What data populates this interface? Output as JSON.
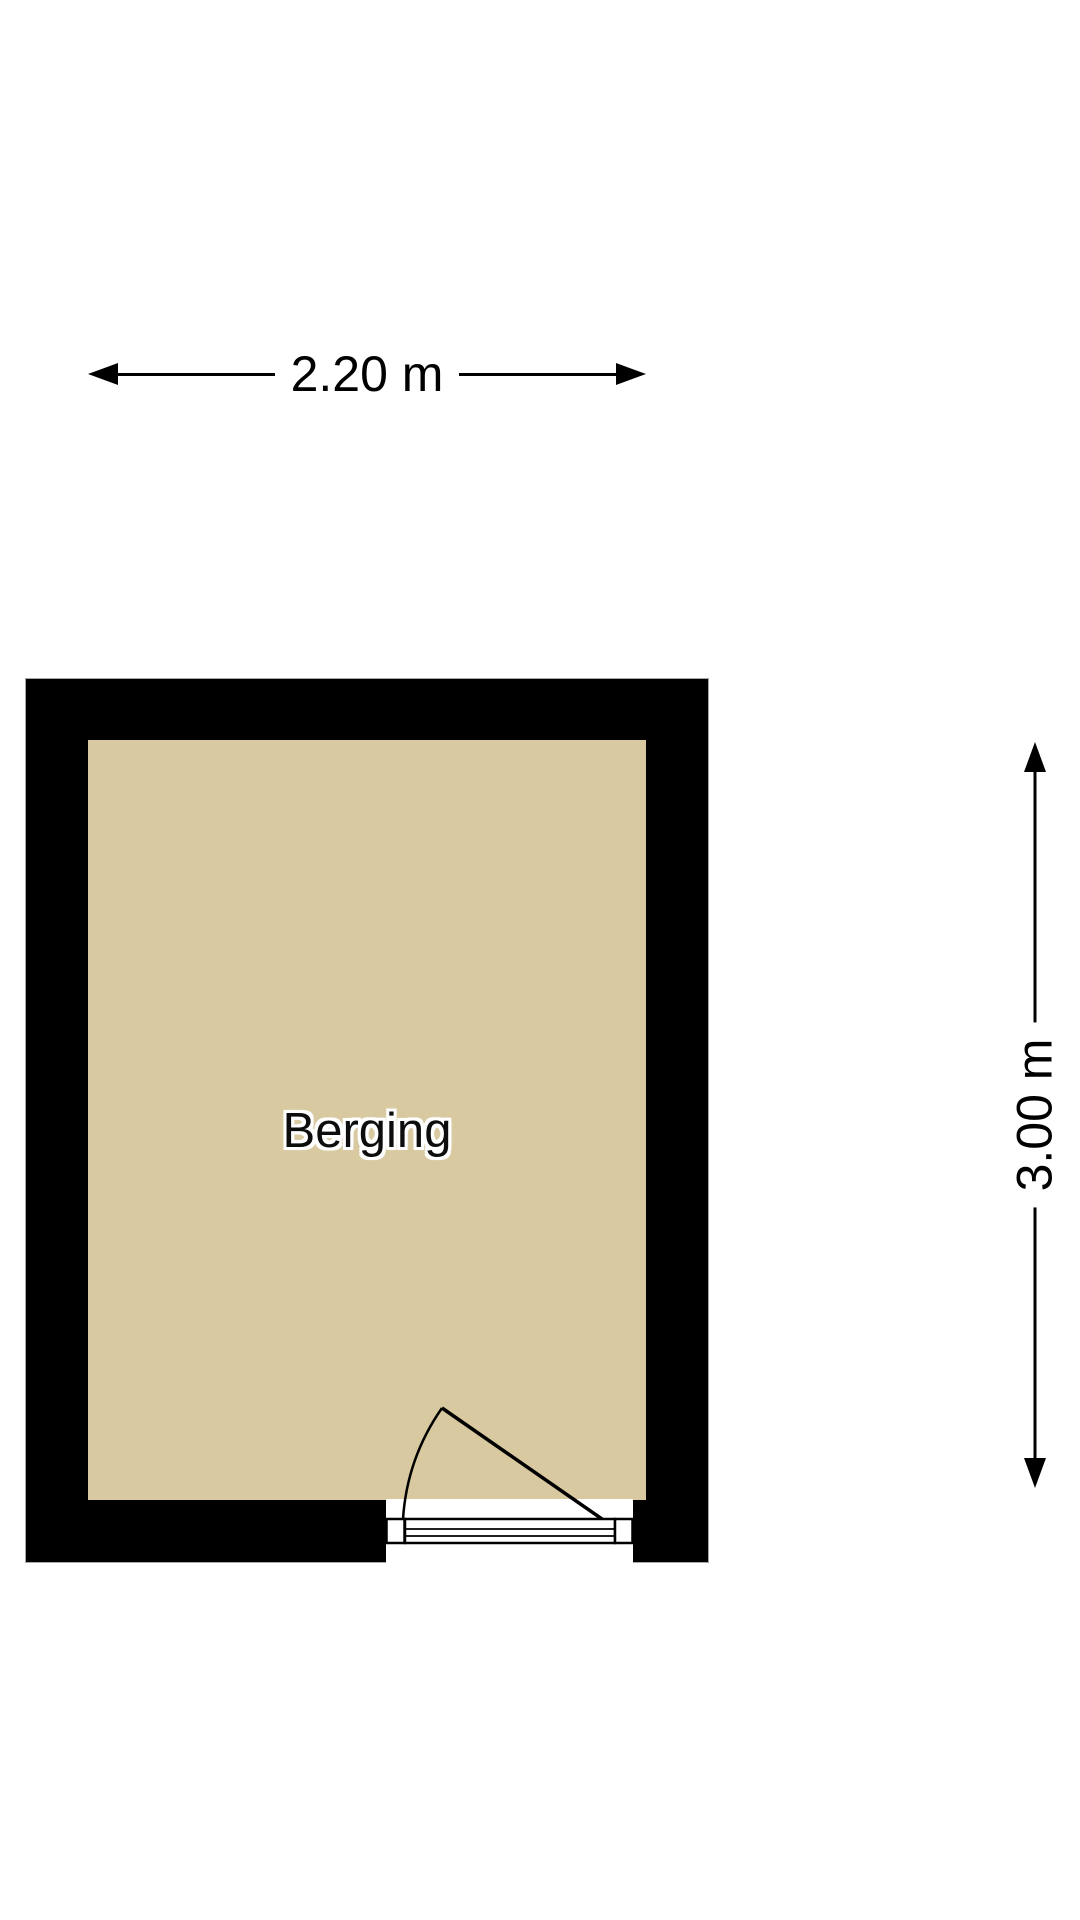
{
  "page": {
    "background_color": "#ffffff"
  },
  "room": {
    "label": "Berging",
    "floor_color": "#d8c9a0",
    "wall_color": "#000000"
  },
  "dimensions": {
    "width_label": "2.20 m",
    "height_label": "3.00 m"
  },
  "icons": {
    "arrows": [
      "arrow-left-icon",
      "arrow-right-icon",
      "arrow-up-icon",
      "arrow-down-icon"
    ]
  }
}
